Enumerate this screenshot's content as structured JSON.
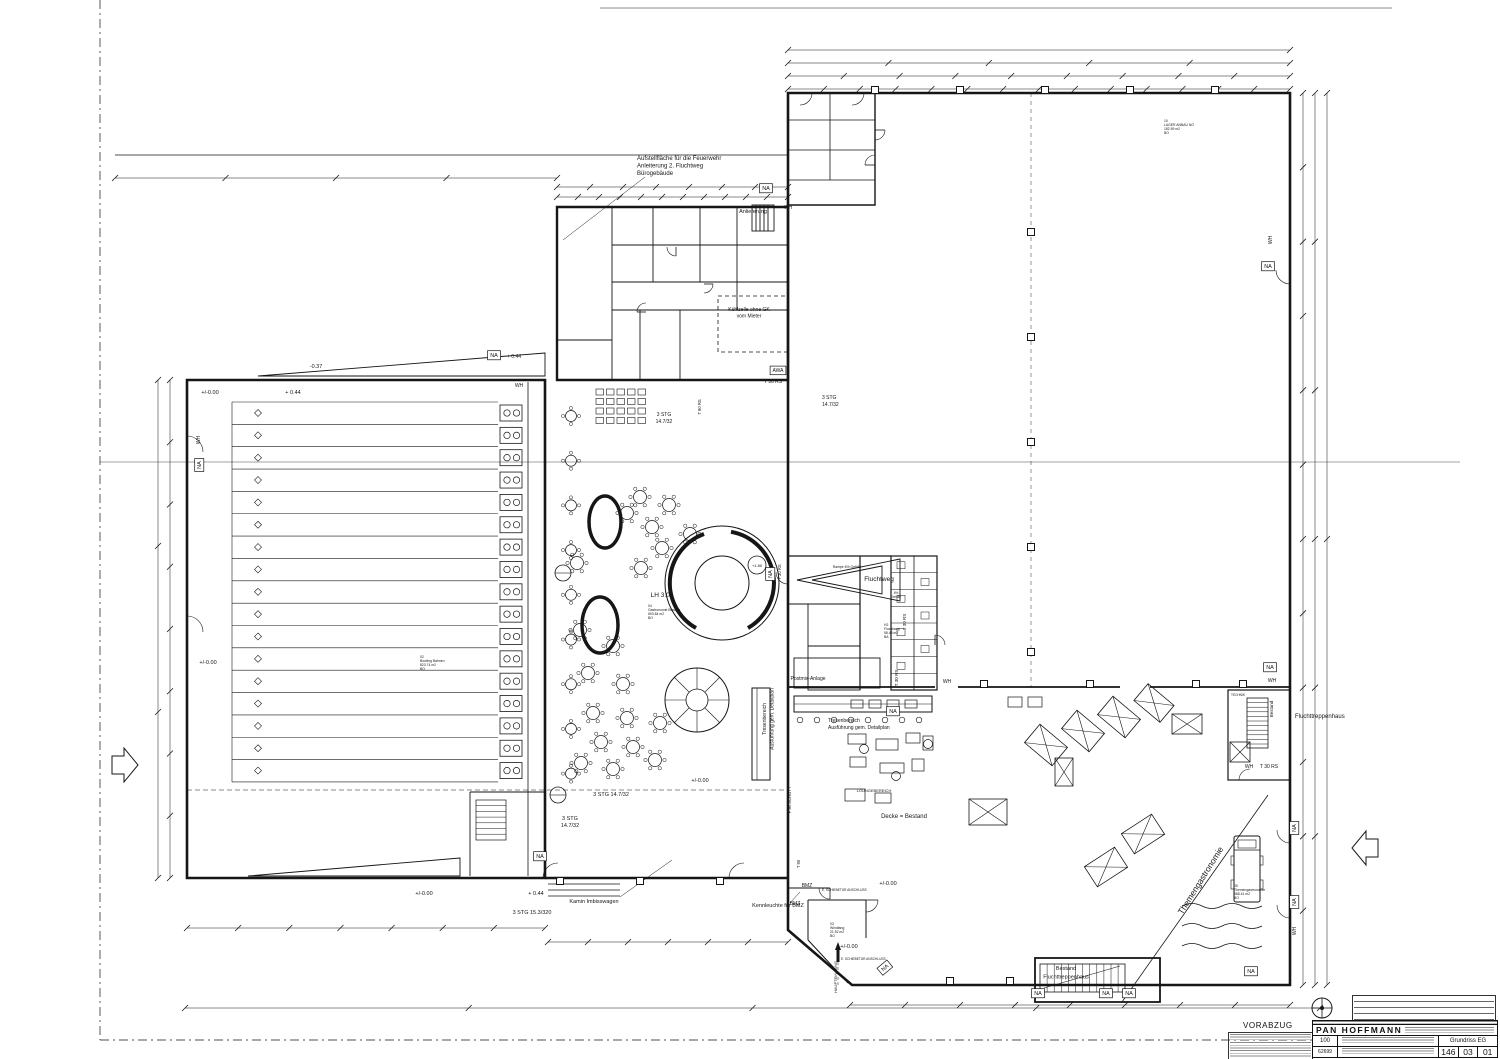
{
  "meta": {
    "paper_color": "#ffffff",
    "ink_color": "#161616"
  },
  "title_block": {
    "status": "VORABZUG",
    "firm": "PAN  HOFFMANN",
    "scale": "100",
    "drawing_title": "Grundriss EG",
    "doc_number": "62699",
    "plan_no": [
      "146",
      "03",
      "01"
    ]
  },
  "labels": [
    {
      "t": "Aufstellfläche für die Feuerwehr",
      "x": 637,
      "y": 160,
      "s": 6,
      "a": "start"
    },
    {
      "t": "Anleiterung 2. Fluchtweg",
      "x": 637,
      "y": 167.5,
      "s": 6,
      "a": "start"
    },
    {
      "t": "Bürogebäude",
      "x": 637,
      "y": 175,
      "s": 6,
      "a": "start"
    },
    {
      "t": "Anlieferung",
      "x": 753,
      "y": 213,
      "s": 5.5
    },
    {
      "t": "NA",
      "x": 766,
      "y": 190,
      "b": 1
    },
    {
      "t": "WH",
      "x": 788,
      "y": 209,
      "s": 5
    },
    {
      "t": "Kühlzelle ohne GK",
      "x": 749,
      "y": 311,
      "s": 5
    },
    {
      "t": "vom Mieter",
      "x": 749,
      "y": 317.5,
      "s": 5
    },
    {
      "t": "NA",
      "x": 1268,
      "y": 268,
      "b": 1
    },
    {
      "t": "WH",
      "x": 1272,
      "y": 240,
      "s": 5,
      "r": -90
    },
    {
      "t": "NA",
      "x": 494,
      "y": 357,
      "b": 1
    },
    {
      "t": "+ 0.44",
      "x": 514,
      "y": 358,
      "s": 5
    },
    {
      "t": "WH",
      "x": 519,
      "y": 387,
      "s": 5
    },
    {
      "t": "-0.37",
      "x": 316,
      "y": 368,
      "s": 5.5
    },
    {
      "t": "+ 0.44",
      "x": 293,
      "y": 394,
      "s": 5.5
    },
    {
      "t": "+/-0.00",
      "x": 210,
      "y": 394,
      "s": 5.5
    },
    {
      "t": "WH",
      "x": 200,
      "y": 440,
      "s": 5,
      "r": -90
    },
    {
      "t": "NA",
      "x": 201,
      "y": 465,
      "b": 1,
      "r": -90
    },
    {
      "t": "+/-0.00",
      "x": 208,
      "y": 664,
      "s": 5.5
    },
    {
      "t": "+/-0.00",
      "x": 424,
      "y": 895,
      "s": 5.5
    },
    {
      "t": "+ 0.44",
      "x": 536,
      "y": 895,
      "s": 5.5
    },
    {
      "t": "3 STG 15.3/320",
      "x": 532,
      "y": 914,
      "s": 5.5
    },
    {
      "t": "Kamin Imbisswagen",
      "x": 594,
      "y": 903,
      "s": 5.5
    },
    {
      "t": "Kennleuchte für BMZ",
      "x": 778,
      "y": 907,
      "s": 5.5
    },
    {
      "t": "+/-0.00",
      "x": 849,
      "y": 948,
      "s": 5.5
    },
    {
      "t": "+/-0.00",
      "x": 888,
      "y": 885,
      "s": 5.5
    },
    {
      "t": "BMZ",
      "x": 807,
      "y": 887,
      "s": 5
    },
    {
      "t": "BMZ",
      "x": 795,
      "y": 905,
      "s": 5
    },
    {
      "t": "NA",
      "x": 886,
      "y": 969,
      "b": 1,
      "r": -40
    },
    {
      "t": "HAUPTEINGANG",
      "x": 837,
      "y": 977,
      "s": 4,
      "r": -90
    },
    {
      "t": "03",
      "x": 830,
      "y": 925,
      "s": 3.4,
      "a": "start"
    },
    {
      "t": "Windfang",
      "x": 830,
      "y": 929,
      "s": 3.4,
      "a": "start"
    },
    {
      "t": "21.52 m2",
      "x": 830,
      "y": 933,
      "s": 3.4,
      "a": "start"
    },
    {
      "t": "BO",
      "x": 830,
      "y": 937,
      "s": 3.4,
      "a": "start"
    },
    {
      "t": "E. SCHIEBETÜR ANSCHLUSS",
      "x": 822,
      "y": 891,
      "s": 3.2,
      "a": "start"
    },
    {
      "t": "E. SCHIEBETÜR ANSCHLUSS",
      "x": 841,
      "y": 960,
      "s": 3.2,
      "a": "start"
    },
    {
      "t": "NA",
      "x": 1038,
      "y": 995,
      "b": 1
    },
    {
      "t": "NA",
      "x": 1106,
      "y": 995,
      "b": 1
    },
    {
      "t": "NA",
      "x": 1129,
      "y": 995,
      "b": 1
    },
    {
      "t": "Bestand",
      "x": 1066,
      "y": 970,
      "s": 5.5
    },
    {
      "t": "Fluchttreppenhaus",
      "x": 1066,
      "y": 978.5,
      "s": 5.5
    },
    {
      "t": "NA",
      "x": 1251,
      "y": 973,
      "b": 1
    },
    {
      "t": "NA",
      "x": 1296,
      "y": 828,
      "b": 1,
      "r": -90
    },
    {
      "t": "NA",
      "x": 1296,
      "y": 902,
      "b": 1,
      "r": -90
    },
    {
      "t": "WH",
      "x": 1296,
      "y": 931,
      "s": 5,
      "r": -90
    },
    {
      "t": "NA",
      "x": 1270,
      "y": 669,
      "b": 1
    },
    {
      "t": "WH",
      "x": 1272,
      "y": 682,
      "s": 5
    },
    {
      "t": "Fluchttreppenhaus",
      "x": 1295,
      "y": 718,
      "s": 6,
      "a": "start"
    },
    {
      "t": "Bestand",
      "x": 1273,
      "y": 709,
      "s": 4.5,
      "r": -90
    },
    {
      "t": "TECHNIK",
      "x": 1238,
      "y": 696,
      "s": 3.2
    },
    {
      "t": "WH",
      "x": 1249,
      "y": 768,
      "s": 5
    },
    {
      "t": "T 30 RS",
      "x": 1269,
      "y": 768,
      "s": 5
    },
    {
      "t": "Fluchtweg",
      "x": 879,
      "y": 581,
      "s": 6.5
    },
    {
      "t": "Rampe 6% Gefälle",
      "x": 847,
      "y": 568,
      "s": 3.4
    },
    {
      "t": "6%",
      "x": 896,
      "y": 594,
      "s": 3.2
    },
    {
      "t": "Gefälle",
      "x": 896,
      "y": 598,
      "s": 3.2
    },
    {
      "t": "H2",
      "x": 884,
      "y": 626,
      "s": 3.4,
      "a": "start"
    },
    {
      "t": "Fluchtweg",
      "x": 884,
      "y": 630,
      "s": 3.4,
      "a": "start"
    },
    {
      "t": "58.43 m2",
      "x": 884,
      "y": 634,
      "s": 3.4,
      "a": "start"
    },
    {
      "t": "BA",
      "x": 884,
      "y": 638,
      "s": 3.4,
      "a": "start"
    },
    {
      "t": "T 30 RS",
      "x": 906,
      "y": 622,
      "s": 4.5,
      "r": -90
    },
    {
      "t": "T 30 RS",
      "x": 898,
      "y": 678,
      "s": 4.5,
      "r": -90
    },
    {
      "t": "WH",
      "x": 947,
      "y": 683,
      "s": 5
    },
    {
      "t": "NA",
      "x": 893,
      "y": 713,
      "b": 1
    },
    {
      "t": "Postmix-Anlage",
      "x": 808,
      "y": 680,
      "s": 5
    },
    {
      "t": "Tresenbereich",
      "x": 766,
      "y": 719,
      "s": 5,
      "r": -90
    },
    {
      "t": "Ausführung gem. Detailplan",
      "x": 773.5,
      "y": 719,
      "s": 5,
      "r": -90
    },
    {
      "t": "Tresenbereich",
      "x": 828,
      "y": 722,
      "s": 5,
      "a": "start"
    },
    {
      "t": "Ausführung gem. Detailplan",
      "x": 828,
      "y": 729,
      "s": 5,
      "a": "start"
    },
    {
      "t": "3 STG 14.7/32",
      "x": 611,
      "y": 796,
      "s": 5.5
    },
    {
      "t": "3 STG",
      "x": 570,
      "y": 820,
      "s": 5.5
    },
    {
      "t": "14.7/32",
      "x": 570,
      "y": 827,
      "s": 5.5
    },
    {
      "t": "F 90 SCHOTT",
      "x": 791,
      "y": 800,
      "s": 4.2,
      "r": -90
    },
    {
      "t": "T 90",
      "x": 800,
      "y": 864,
      "s": 4.2,
      "r": -90
    },
    {
      "t": "+/-0.00",
      "x": 700,
      "y": 782,
      "s": 5.5
    },
    {
      "t": "LOUNGEBEREICH",
      "x": 874,
      "y": 792,
      "s": 4
    },
    {
      "t": "Decke = Bestand",
      "x": 904,
      "y": 818,
      "s": 6
    },
    {
      "t": "LH 3.04",
      "x": 662,
      "y": 597,
      "s": 6.5
    },
    {
      "t": "04",
      "x": 648,
      "y": 607,
      "s": 3.4,
      "a": "start"
    },
    {
      "t": "Gastronomie Bowling",
      "x": 648,
      "y": 611,
      "s": 3.4,
      "a": "start"
    },
    {
      "t": "693.84 m2",
      "x": 648,
      "y": 615,
      "s": 3.4,
      "a": "start"
    },
    {
      "t": "BO",
      "x": 648,
      "y": 619,
      "s": 3.4,
      "a": "start"
    },
    {
      "t": "+1.80",
      "x": 757,
      "y": 567,
      "s": 4
    },
    {
      "t": "NA",
      "x": 772,
      "y": 574,
      "b": 1,
      "r": -90
    },
    {
      "t": "T 30 RS",
      "x": 781,
      "y": 572,
      "s": 4.2,
      "r": -90
    },
    {
      "t": "02",
      "x": 420,
      "y": 658,
      "s": 3.4,
      "a": "start"
    },
    {
      "t": "Bowling Bahnen",
      "x": 420,
      "y": 662,
      "s": 3.4,
      "a": "start"
    },
    {
      "t": "823.74 m2",
      "x": 420,
      "y": 666,
      "s": 3.4,
      "a": "start"
    },
    {
      "t": "BO",
      "x": 420,
      "y": 670,
      "s": 3.4,
      "a": "start"
    },
    {
      "t": "10",
      "x": 1164,
      "y": 122,
      "s": 3.4,
      "a": "start"
    },
    {
      "t": "LAGER ANBAU NO",
      "x": 1164,
      "y": 126,
      "s": 3.4,
      "a": "start"
    },
    {
      "t": "182.59 m2",
      "x": 1164,
      "y": 130,
      "s": 3.4,
      "a": "start"
    },
    {
      "t": "BO",
      "x": 1164,
      "y": 134,
      "s": 3.4,
      "a": "start"
    },
    {
      "t": "05",
      "x": 1234,
      "y": 887,
      "s": 3.4,
      "a": "start"
    },
    {
      "t": "Themengastronomie",
      "x": 1234,
      "y": 891,
      "s": 3.4,
      "a": "start"
    },
    {
      "t": "568.41 m2",
      "x": 1234,
      "y": 895,
      "s": 3.4,
      "a": "start"
    },
    {
      "t": "BO",
      "x": 1234,
      "y": 899,
      "s": 3.4,
      "a": "start"
    },
    {
      "t": "Themengastronomie",
      "x": 1203,
      "y": 882,
      "s": 8.5,
      "r": -58
    },
    {
      "t": "T 90 RS",
      "x": 773,
      "y": 383,
      "s": 5
    },
    {
      "t": "T 90 RS",
      "x": 701,
      "y": 407,
      "s": 4.2,
      "r": -90
    },
    {
      "t": "AWA",
      "x": 778,
      "y": 372,
      "b": 1,
      "s": 5
    },
    {
      "t": "3 STG",
      "x": 822,
      "y": 399,
      "s": 5,
      "a": "start"
    },
    {
      "t": "14.7/32",
      "x": 822,
      "y": 406,
      "s": 5,
      "a": "start"
    },
    {
      "t": "3 STG",
      "x": 664,
      "y": 416,
      "s": 5
    },
    {
      "t": "14.7/32",
      "x": 664,
      "y": 423,
      "s": 5
    },
    {
      "t": "NA",
      "x": 540,
      "y": 858,
      "b": 1
    }
  ]
}
